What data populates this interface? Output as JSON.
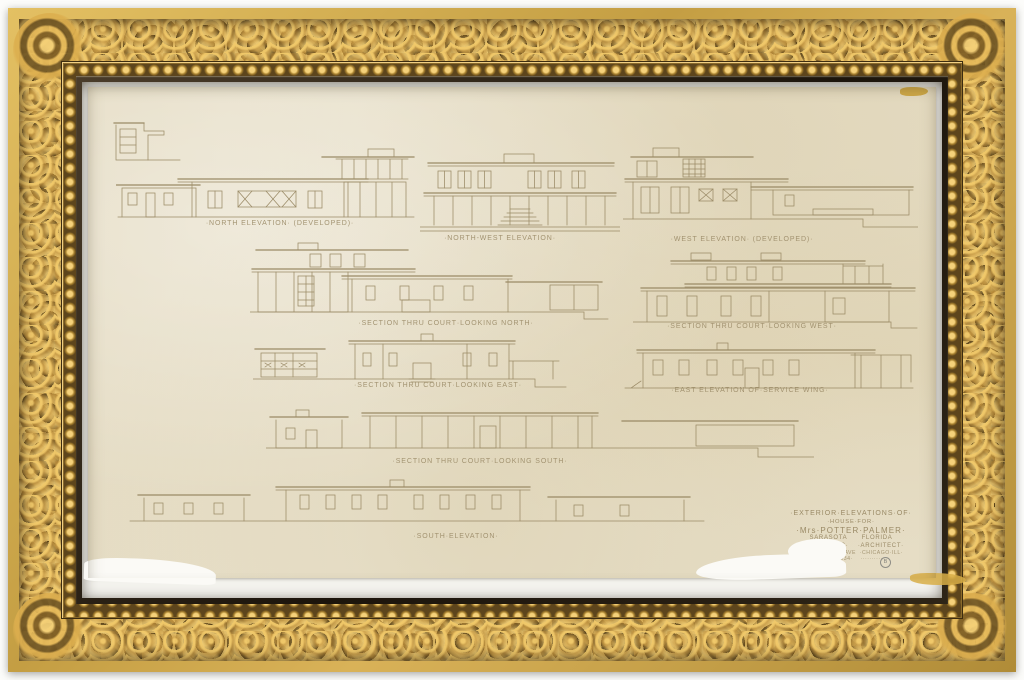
{
  "artwork": {
    "description": "Framed pencil architectural drawing, sheet of exterior elevations for a modernist house, in an ornate carved gilt frame",
    "drawings": [
      {
        "id": "north-elevation",
        "label": "·NORTH ELEVATION· (DEVELOPED)·"
      },
      {
        "id": "northwest-elevation",
        "label": "·NORTH-WEST ELEVATION·"
      },
      {
        "id": "west-elevation",
        "label": "·WEST ELEVATION· (DEVELOPED)·"
      },
      {
        "id": "section-thru-court-north",
        "label": "·SECTION THRU COURT·LOOKING NORTH·"
      },
      {
        "id": "section-thru-court-west",
        "label": "·SECTION THRU COURT·LOOKING WEST·"
      },
      {
        "id": "section-thru-court-east",
        "label": "·SECTION THRU COURT·LOOKING EAST·"
      },
      {
        "id": "east-elevation-service",
        "label": "·EAST ELEVATION OF·SERVICE WING·"
      },
      {
        "id": "section-thru-court-south",
        "label": "·SECTION THRU COURT·LOOKING SOUTH·"
      },
      {
        "id": "south-elevation",
        "label": "·SOUTH·ELEVATION·"
      }
    ],
    "title_block": {
      "lines": [
        "·EXTERIOR·ELEVATIONS·OF·",
        "·HOUSE·FOR·",
        "·Mrs·POTTER·PALMER·",
        "SARASOTA      FLORIDA",
        "DAVID·ADLER·    ·ARCHITECT·",
        "·NO·MICHIGAN·AVE  ·CHICAGO·ILL·",
        "JUNE·1934·    ··········"
      ]
    },
    "corner_mark": "B"
  },
  "colors": {
    "frame_gold": "#d9b258",
    "frame_bronze": "#6e5423",
    "frame_lip": "#1c150c",
    "mat_white": "#f3f2ed",
    "paper": "#eae3cf",
    "ink": "#9a8a66",
    "stain": "#c79a28"
  }
}
